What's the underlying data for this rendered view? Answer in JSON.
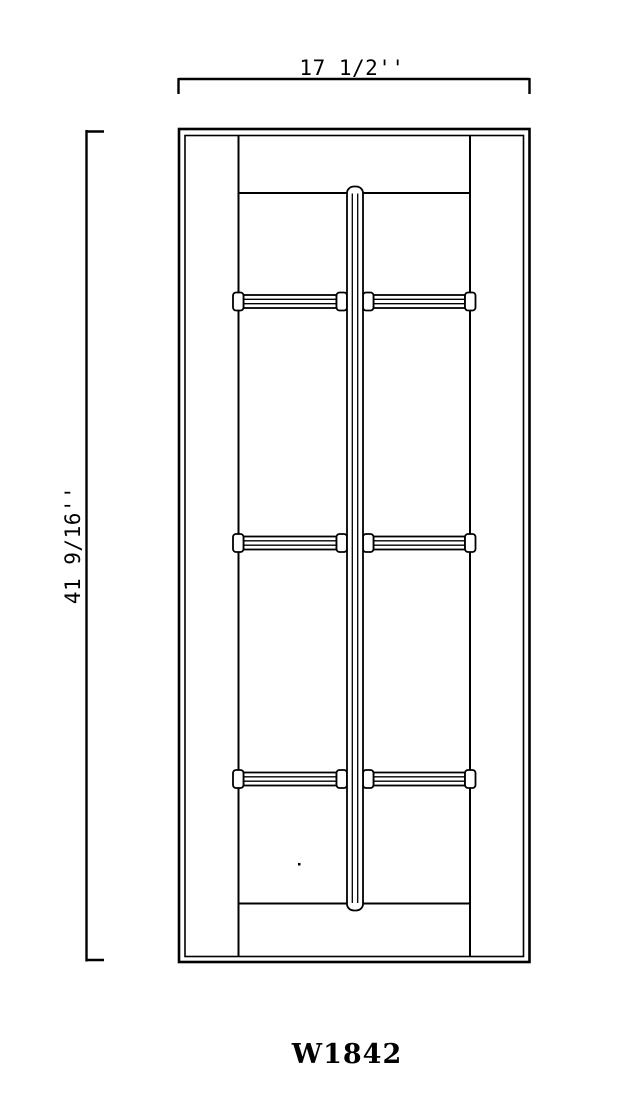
{
  "drawing": {
    "background_color": "#ffffff",
    "line_color": "#000000",
    "top_dimension": "17 1/2''",
    "side_dimension": "41 9/16''",
    "product_code": "W1842",
    "door": {
      "glass_columns": 2,
      "glass_rows": 4,
      "glass_lites": 8
    }
  }
}
